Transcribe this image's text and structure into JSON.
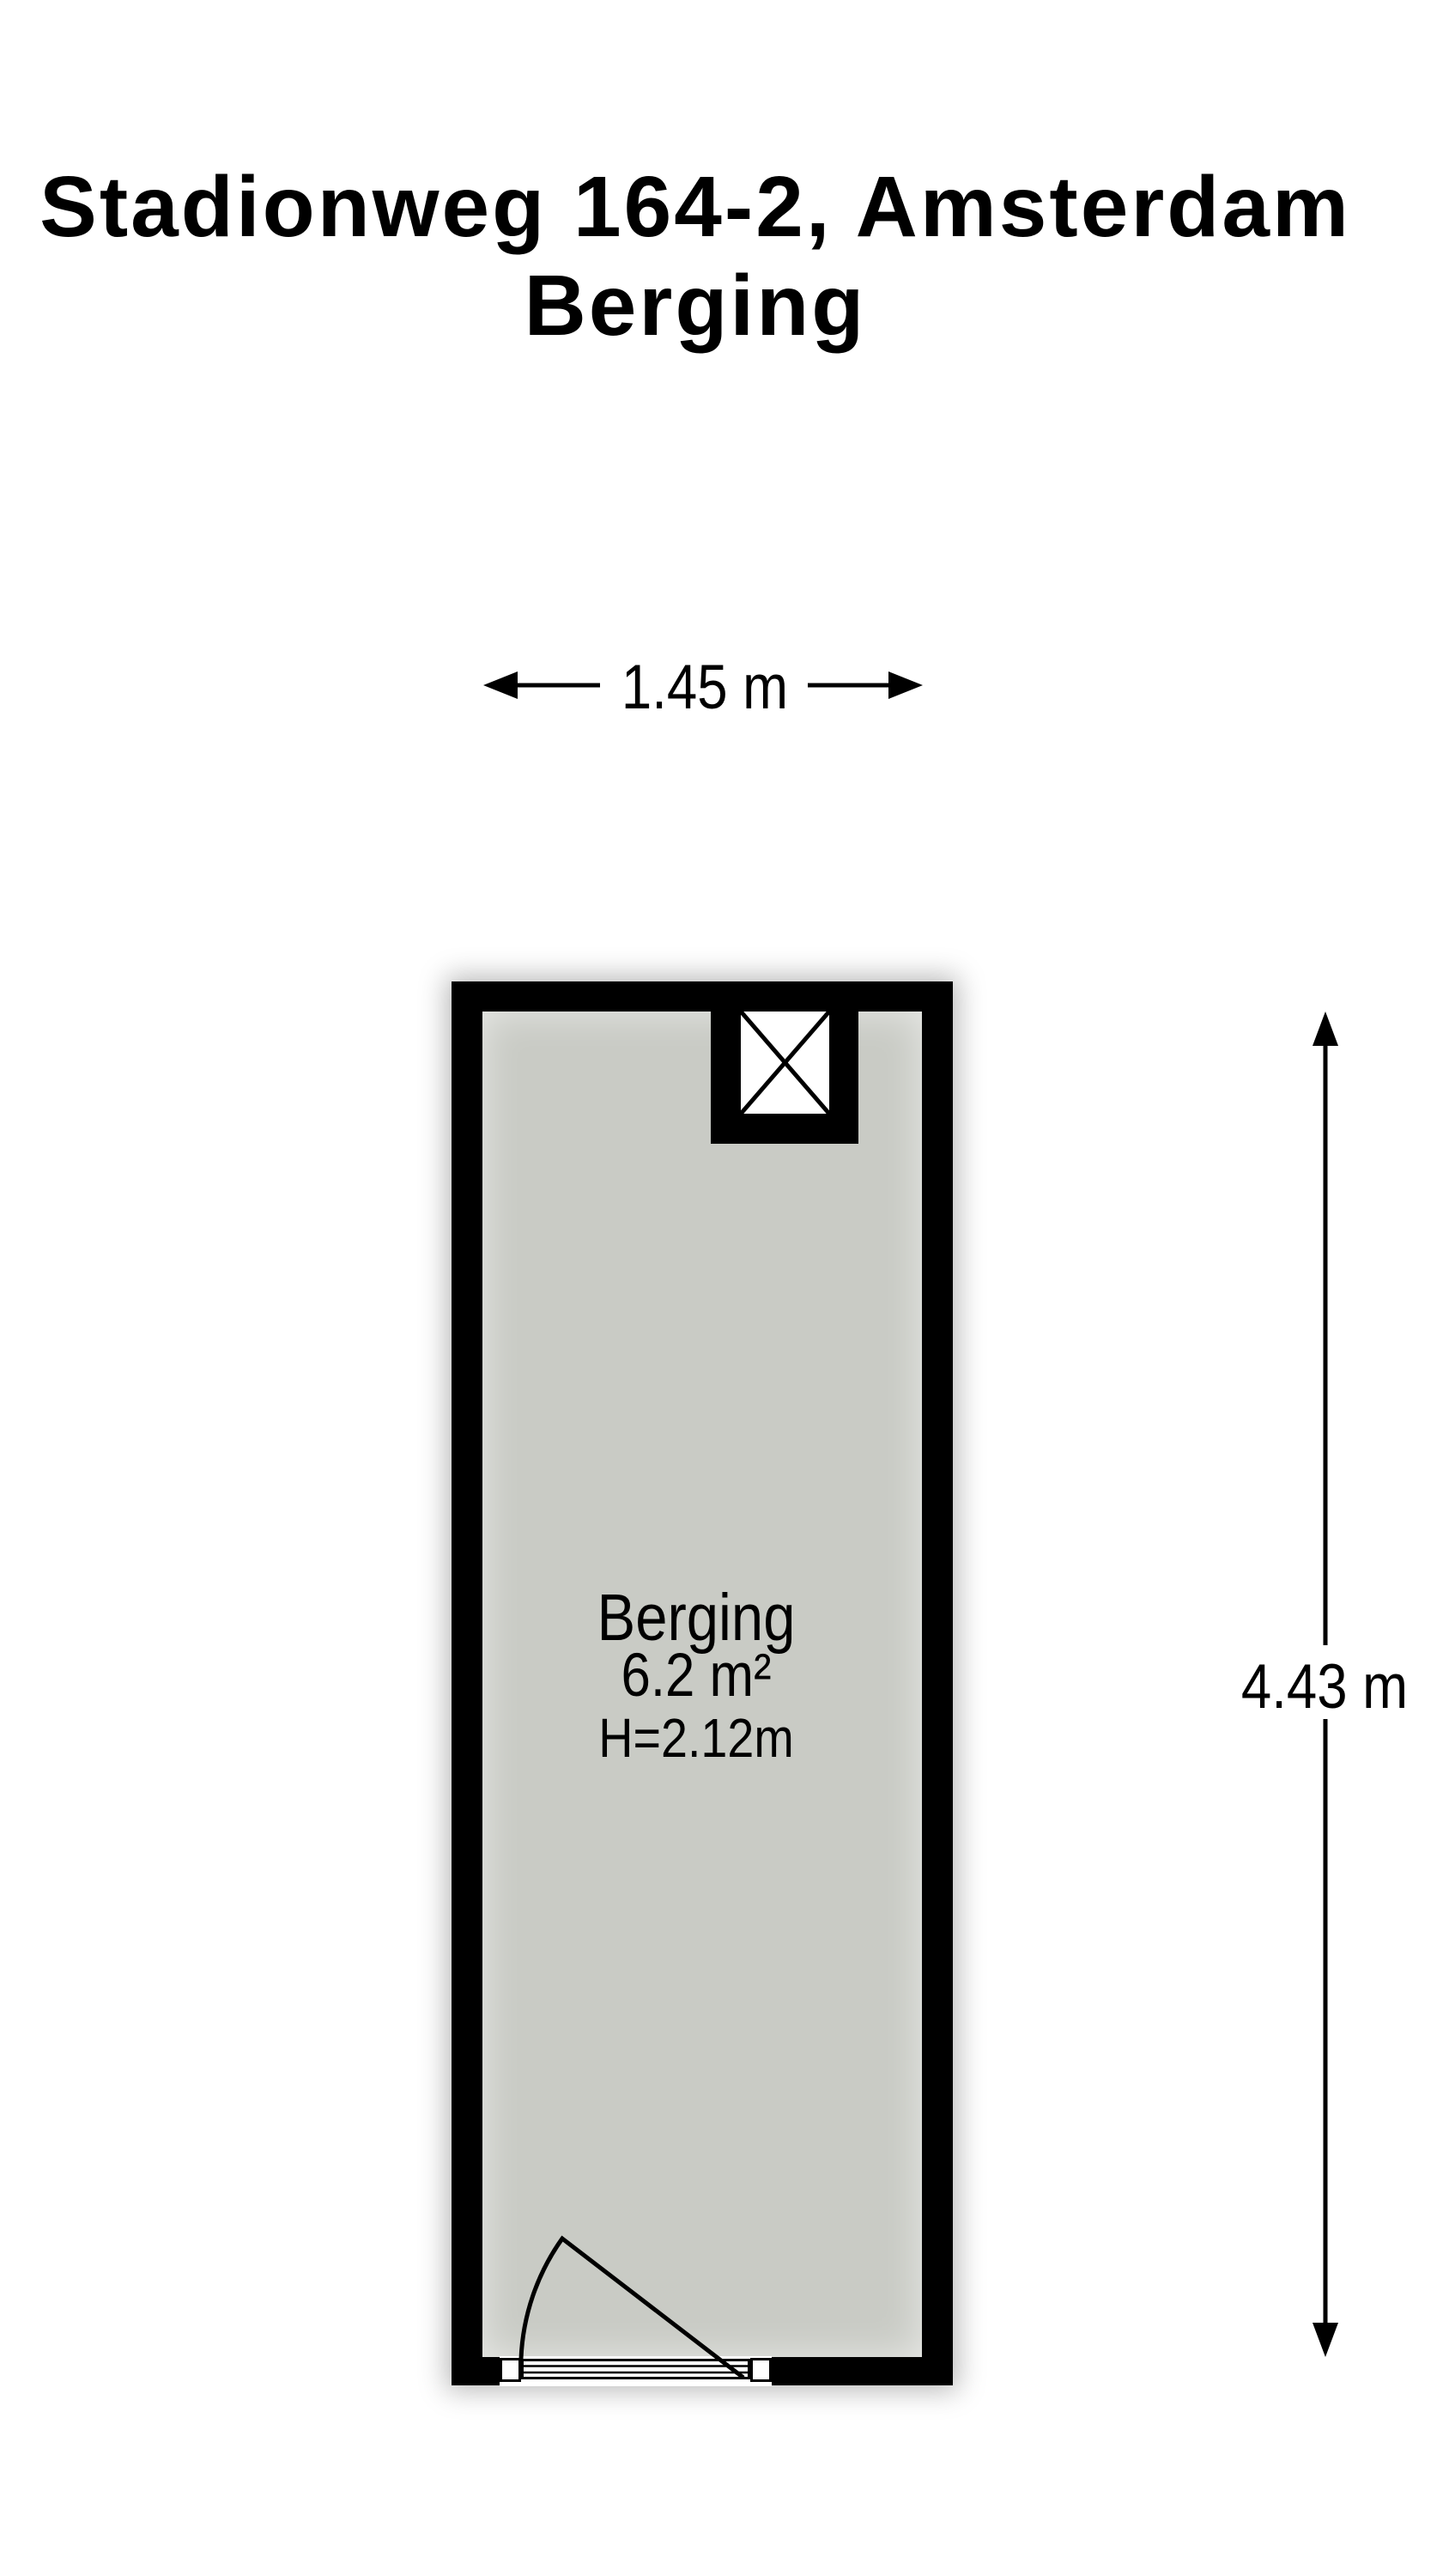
{
  "title": {
    "address": "Stadionweg 164-2, Amsterdam",
    "subtitle": "Berging"
  },
  "dimensions": {
    "width": "1.45 m",
    "height": "4.43 m"
  },
  "room": {
    "name": "Berging",
    "area": "6.2 m²",
    "ceiling_height": "H=2.12m"
  },
  "colors": {
    "wall": "#000000",
    "floor": "#c9cbc5",
    "background": "#ffffff",
    "text": "#000000"
  }
}
